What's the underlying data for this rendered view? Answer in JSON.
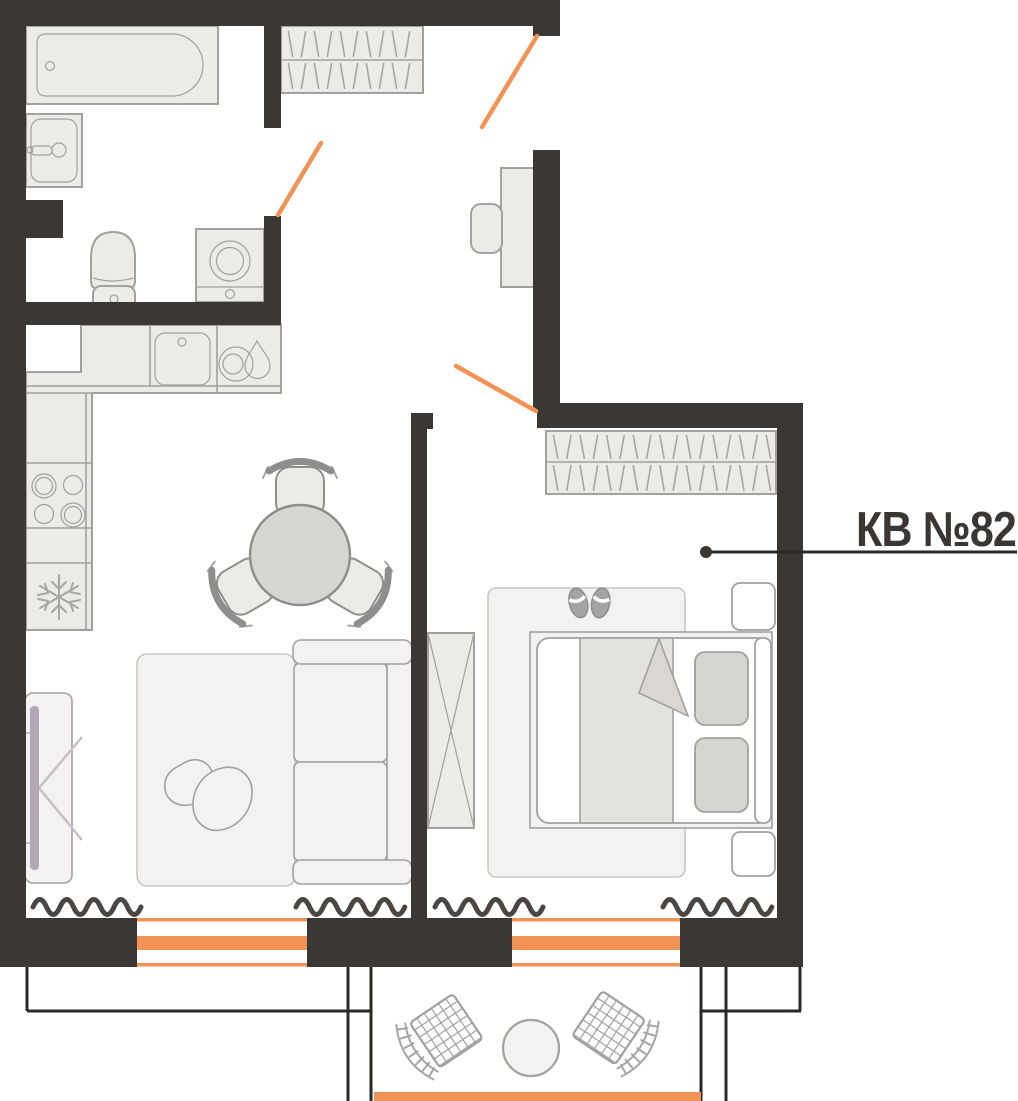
{
  "label": {
    "apartment_number": "КВ №82"
  },
  "colors": {
    "wall": "#3b3734",
    "orange": "#f09355",
    "furn": "#edebe8",
    "border": "#a3a19f",
    "light": "#f3f2f0",
    "shade": "#d7d5d2",
    "white": "#ffffff",
    "blanket": "#e4e2df",
    "fold": "#d9d6d3",
    "tv": "#b5a8b6",
    "tvline": "#c8bdc8",
    "radiator": "#4a4643",
    "thin": "#2c2927",
    "text": "#3a3633",
    "slipper": "#a6a4a2"
  },
  "icons": {
    "bathtub": "bathtub-icon",
    "bath_sink": "sink-icon",
    "toilet": "toilet-icon",
    "washing_machine": "washing-machine-icon",
    "kitchen_sink": "kitchen-sink-icon",
    "dishwasher": "water-drop-icon",
    "stove": "burners-icon",
    "fridge": "snowflake-icon",
    "wardrobe": "hanger-rack-icon",
    "slippers": "slippers-icon",
    "tv": "tv-icon",
    "radiator": "radiator-wave-icon",
    "door_swing": "door-swing-line",
    "window": "window-glazing-line"
  }
}
